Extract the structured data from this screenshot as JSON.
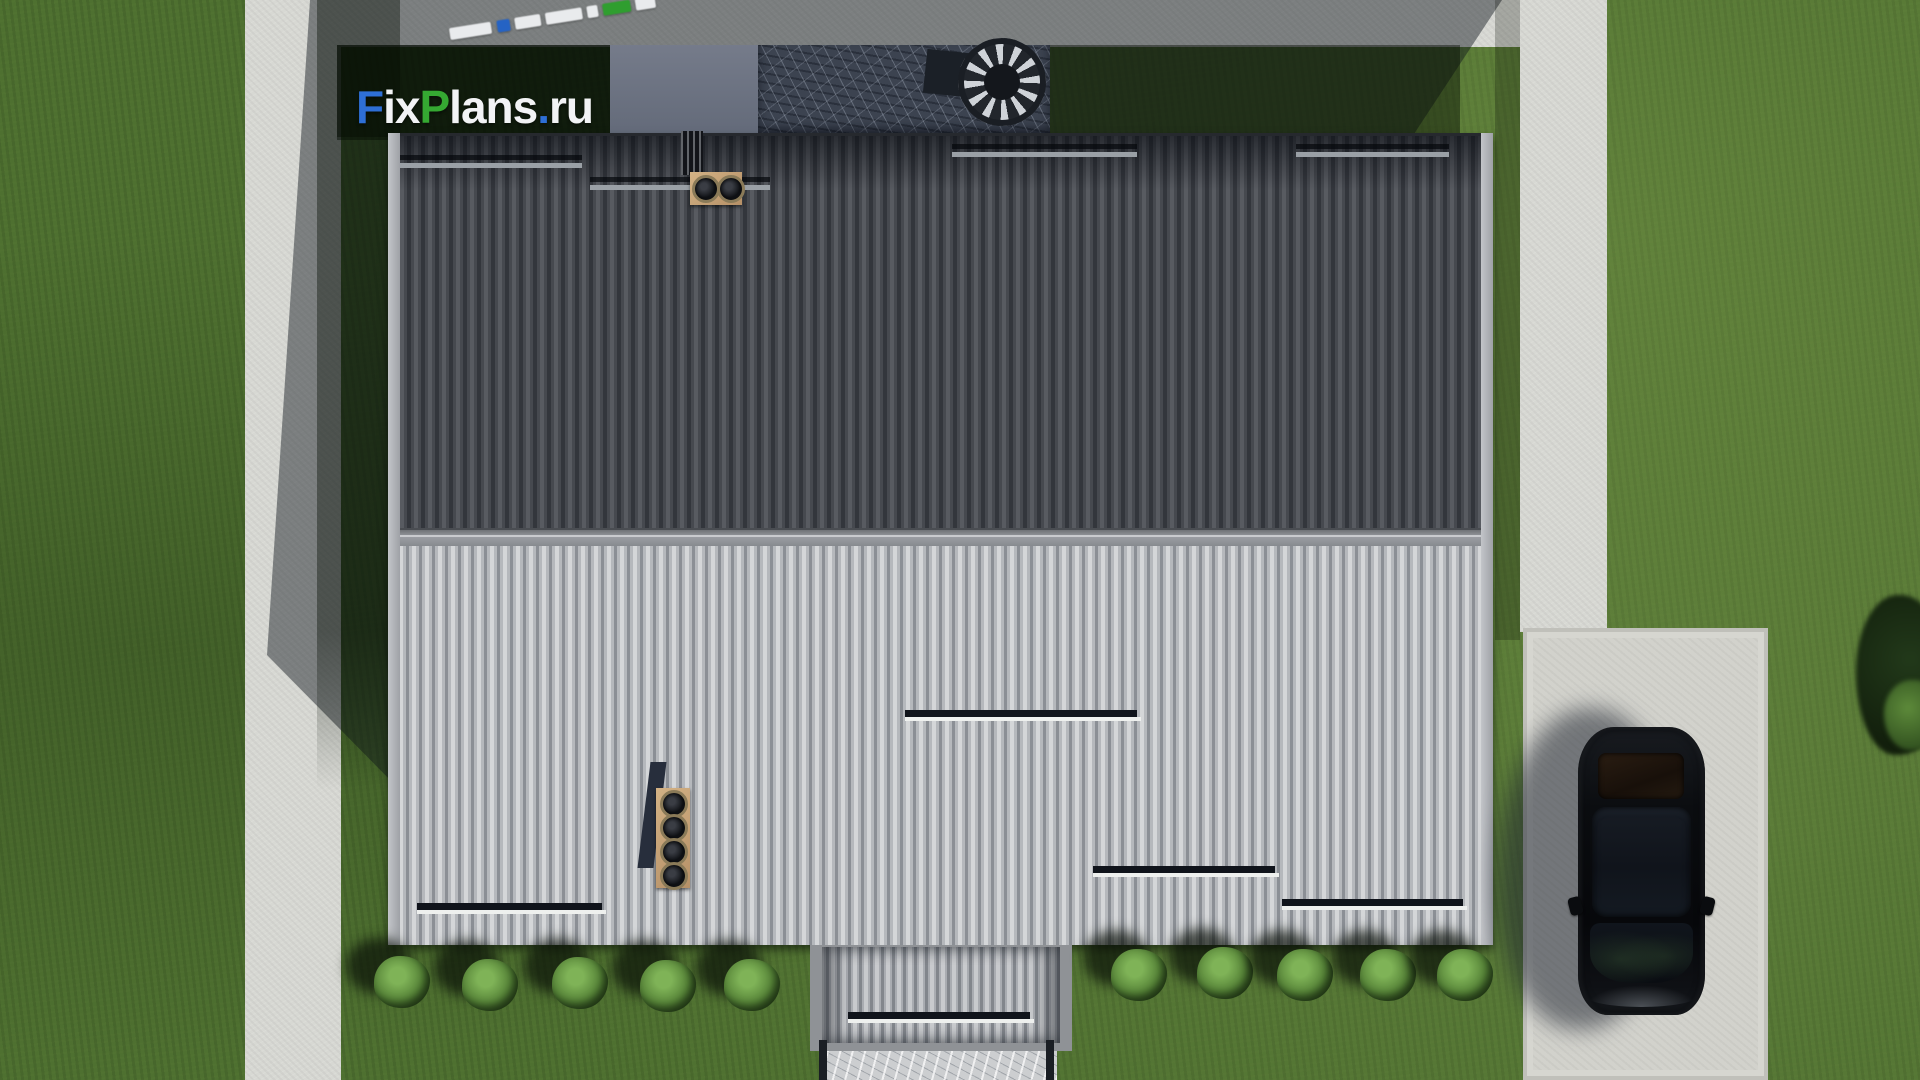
{
  "watermark": {
    "full_text": "FixPlans.ru",
    "background": "#131f0e",
    "segments": [
      {
        "text": "F",
        "color": "#2e6fd6"
      },
      {
        "text": "ix",
        "color": "#f2f3f5"
      },
      {
        "text": "P",
        "color": "#35a832"
      },
      {
        "text": "lans",
        "color": "#f2f3f5"
      },
      {
        "text": ".",
        "color": "#2e6fd6"
      },
      {
        "text": "ru",
        "color": "#f2f3f5"
      }
    ]
  },
  "scene": {
    "description": "Aerial top-down 3D render of a house roof",
    "colors": {
      "grass": "#4e7030",
      "grass_shadow": "#1c2a14",
      "concrete_path": "#d7d8d3",
      "driveway": "#d2d2cc",
      "roof_dark_tiles": "#43464c",
      "roof_light_tiles": "#b2b5ba",
      "ridge": "#9a9da2",
      "chimney_plate": "#c2a478",
      "terrace_marble": "#3c4350",
      "car_body": "#0b0d10",
      "bush": "#558237"
    },
    "objects": [
      "dark tiled roof slope",
      "light ribbed roof slope",
      "roof ridge",
      "snow guard rails",
      "chimney with two round vents",
      "chimney with four round vents",
      "ridge vent grille",
      "rear terrace with marble paving",
      "spiral staircase",
      "entrance porch roof",
      "stone walkway",
      "black sedan on driveway",
      "garden bushes",
      "concrete paths",
      "lawn"
    ]
  }
}
